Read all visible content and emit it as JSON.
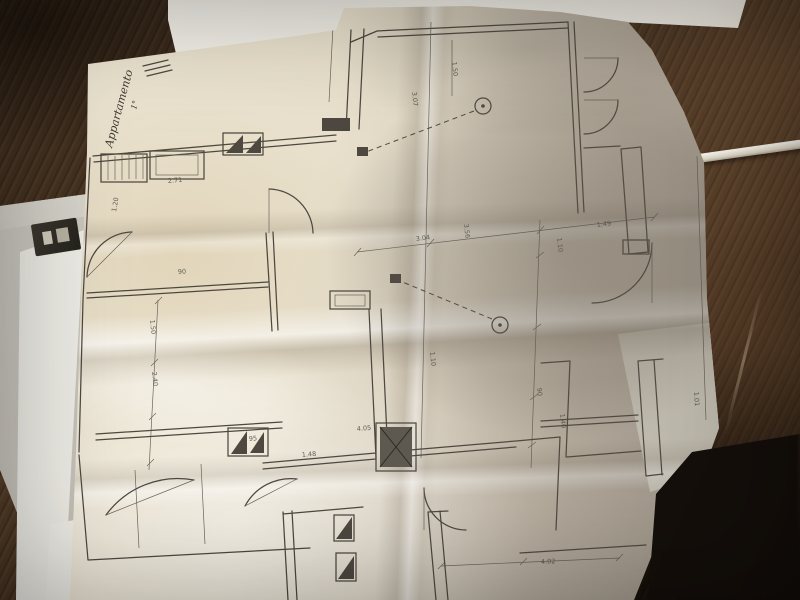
{
  "scene": {
    "type": "photograph",
    "description": "Creased hand-drawn architectural floor plan unfolded on a dark wooden table, with a blank white sheet above, a stack of papers with a dark clip at the left edge, a white pen at the right edge and a deep shadow in the lower-right corner",
    "objects": {
      "table": "dark wooden table surface",
      "blank_sheet": "blank white paper sheet",
      "paper_stack": "stack of papers and board",
      "binder_clip": "dark clip on paper stack",
      "pen": "white pen",
      "floorplan_paper": "folded floor plan drawing",
      "shadow": "dark shadow lower right"
    }
  },
  "colors": {
    "wood_dark": "#241810",
    "wood_mid": "#4a3522",
    "wood_light": "#6a4d33",
    "paper_warm": "#e6ddca",
    "paper_bright": "#f2efe6",
    "paper_shadow": "#a89f93",
    "blank_sheet": "#f4f1ea",
    "ink": "#4d4840",
    "dark_corner": "#15100c"
  },
  "plan": {
    "drawing_type": "floor-plan",
    "handwritten_note": "Appartamento",
    "handwritten_note_2": "1°",
    "margin_note": "240,76",
    "symbols": [
      "wall-double-line",
      "door-swing-arc",
      "hatched-window",
      "ceiling-light-circle",
      "switch-leader-dashed-line",
      "shaft-hatched-box",
      "dimension-chain"
    ],
    "dimension_labels": [
      {
        "text": "2.71",
        "x": 168,
        "y": 183,
        "r": -5
      },
      {
        "text": "90",
        "x": 178,
        "y": 274,
        "r": -4
      },
      {
        "text": "1.20",
        "x": 116,
        "y": 212,
        "r": -80
      },
      {
        "text": "3.04",
        "x": 416,
        "y": 241,
        "r": -7
      },
      {
        "text": "1.49",
        "x": 597,
        "y": 227,
        "r": -7
      },
      {
        "text": "1.50",
        "x": 452,
        "y": 62,
        "r": 84
      },
      {
        "text": "3.07",
        "x": 412,
        "y": 92,
        "r": 84
      },
      {
        "text": "3.56",
        "x": 464,
        "y": 224,
        "r": 84
      },
      {
        "text": "1.10",
        "x": 557,
        "y": 238,
        "r": 84
      },
      {
        "text": "90",
        "x": 537,
        "y": 388,
        "r": 84
      },
      {
        "text": "1.40",
        "x": 560,
        "y": 414,
        "r": 84
      },
      {
        "text": "1.10",
        "x": 430,
        "y": 352,
        "r": 84
      },
      {
        "text": "4.05",
        "x": 357,
        "y": 431,
        "r": -5
      },
      {
        "text": "95",
        "x": 249,
        "y": 441,
        "r": -5
      },
      {
        "text": "1.48",
        "x": 302,
        "y": 457,
        "r": -5
      },
      {
        "text": "4.02",
        "x": 541,
        "y": 564,
        "r": -3
      },
      {
        "text": "1.01",
        "x": 694,
        "y": 392,
        "r": 86
      },
      {
        "text": "1.50",
        "x": 150,
        "y": 320,
        "r": 84
      },
      {
        "text": "2.40",
        "x": 152,
        "y": 372,
        "r": 84
      }
    ]
  }
}
